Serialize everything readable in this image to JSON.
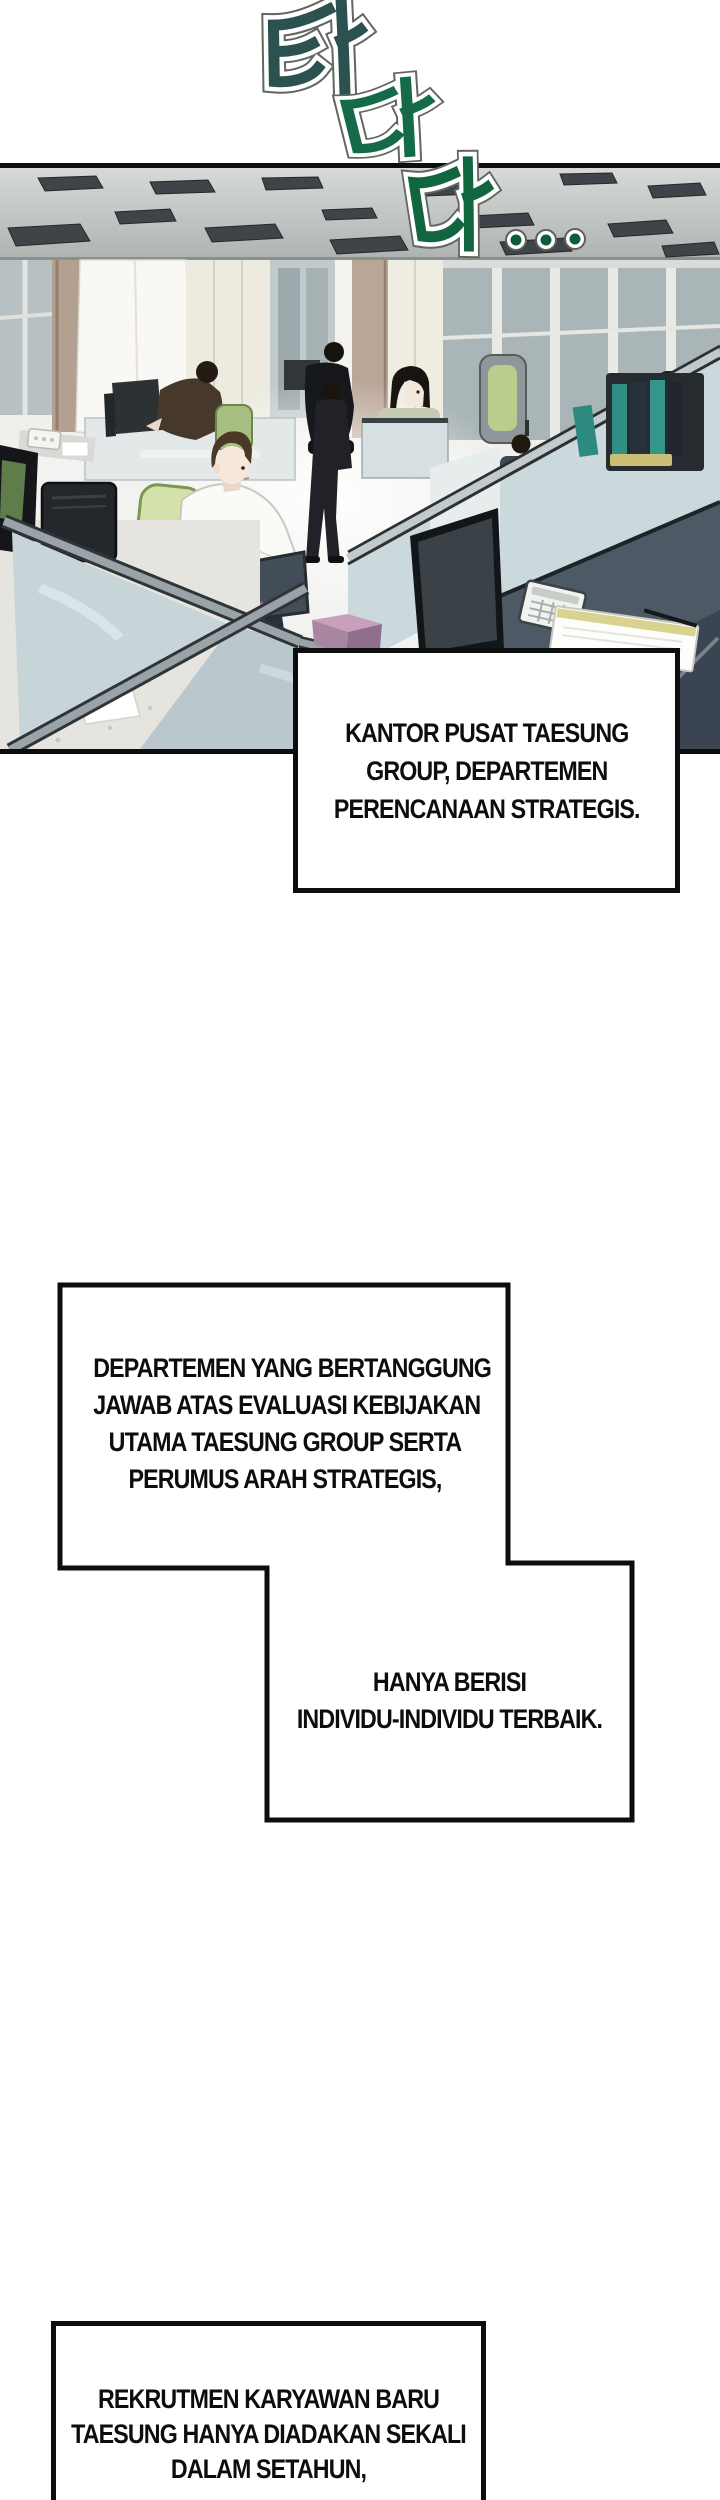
{
  "page": {
    "kind": "webtoon-comic-page",
    "background": "#ffffff",
    "panel_border_color": "#0d0d0d"
  },
  "sfx": {
    "chars": [
      "타",
      "다",
      "다"
    ],
    "romanized": "ta-da-da (typing sound)",
    "ellipsis": ". . .",
    "colors": [
      "#2b524e",
      "#156a49",
      "#11653f"
    ],
    "dot_color": "#0f5c3a",
    "outline_color": "#ffffff"
  },
  "scene": {
    "alt": "Open-plan office floor with gray ceiling vents, window wall, cubicle partitions, green chairs and employees working at monitors"
  },
  "captions": {
    "c1": {
      "lines": [
        "KANTOR PUSAT TAESUNG",
        "GROUP, DEPARTEMEN",
        "PERENCANAAN STRATEGIS."
      ]
    },
    "c2a": {
      "lines": [
        "DEPARTEMEN YANG BERTANGGUNG",
        "JAWAB ATAS EVALUASI KEBIJAKAN",
        "UTAMA TAESUNG GROUP SERTA",
        "PERUMUS ARAH STRATEGIS,"
      ]
    },
    "c2b": {
      "lines": [
        "HANYA BERISI",
        "INDIVIDU-INDIVIDU TERBAIK."
      ]
    },
    "c3": {
      "lines": [
        "REKRUTMEN KARYAWAN BARU",
        "TAESUNG HANYA DIADAKAN SEKALI",
        "DALAM SETAHUN,"
      ]
    }
  }
}
